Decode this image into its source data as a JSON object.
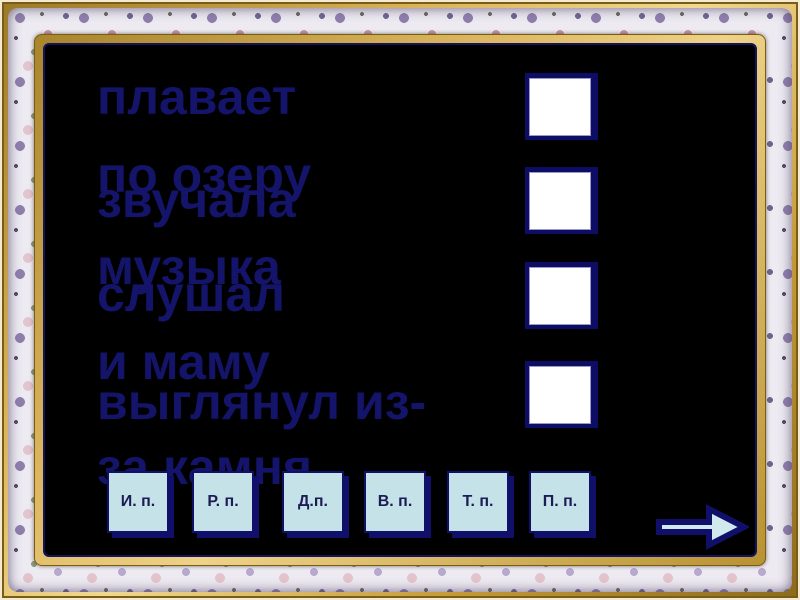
{
  "slide": {
    "type": "grammar-case-exercise",
    "background_color": "#000000",
    "phrase_text_color": "#14146b",
    "navy_accent": "#10106a",
    "button_fill_color": "#c5e2e8",
    "answer_box_fill_color": "#ffffff",
    "frame_gold_color": "#d9b258",
    "frame_fabric_color": "#edeaf2"
  },
  "phrases": [
    {
      "line1": "плавает",
      "line2": "по озеру"
    },
    {
      "line1": "звучала",
      "line2": "музыка"
    },
    {
      "line1": "слушал",
      "line2": "и маму"
    },
    {
      "line1": "выглянул из-",
      "line2": "за камня"
    }
  ],
  "answer_boxes": {
    "count": 4
  },
  "case_buttons": [
    {
      "label": "И. п."
    },
    {
      "label": "Р. п."
    },
    {
      "label": "Д.п."
    },
    {
      "label": "В. п."
    },
    {
      "label": "Т. п."
    },
    {
      "label": "П. п."
    }
  ],
  "navigation": {
    "next": "next-arrow"
  }
}
